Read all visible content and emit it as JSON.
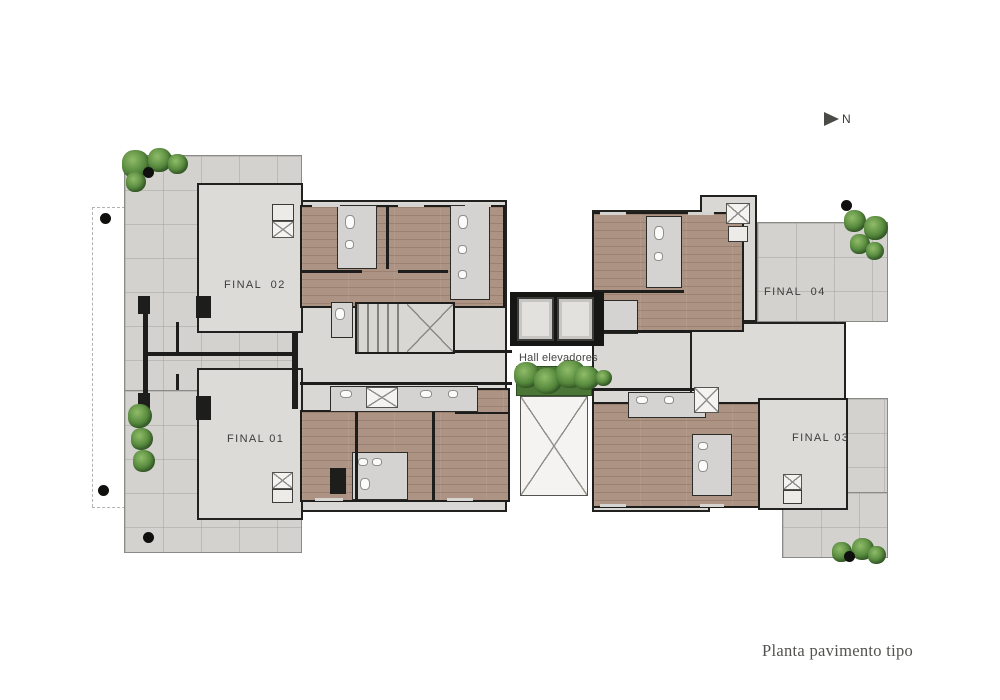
{
  "caption": "Planta pavimento tipo",
  "compass": {
    "label": "N",
    "icon": "north-arrow"
  },
  "hall": {
    "label": "Hall elevadores"
  },
  "units": [
    {
      "id": "final-01",
      "label": "FINAL 01"
    },
    {
      "id": "final-02",
      "label": "FINAL  02"
    },
    {
      "id": "final-03",
      "label": "FINAL 03"
    },
    {
      "id": "final-04",
      "label": "FINAL  04"
    }
  ],
  "colors": {
    "wood_floor": "#ac9383",
    "interior_floor": "#d9d8d5",
    "terrace_floor": "#d3d2cf",
    "wall": "#1d1d1b",
    "plant_green": "#55813c",
    "label_text": "#3c3c3a",
    "caption_text": "#53524e",
    "background": "#ffffff"
  }
}
